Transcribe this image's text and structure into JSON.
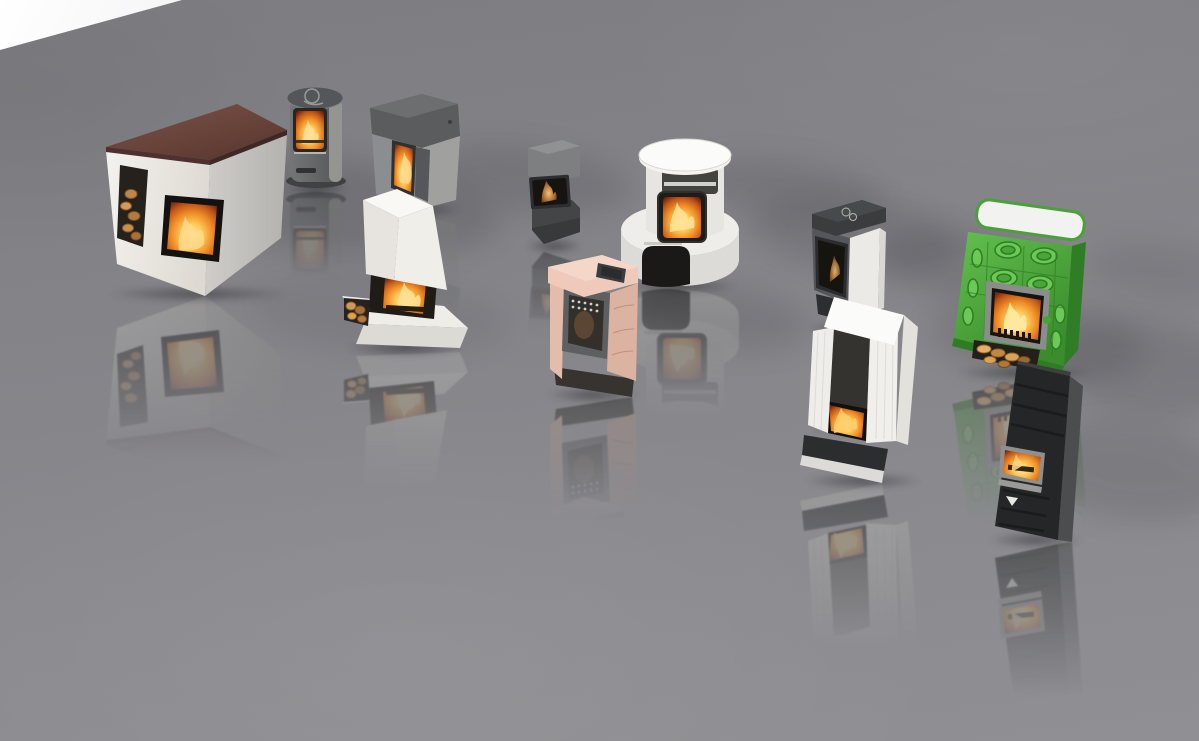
{
  "scene": {
    "title": "3D render of thirteen fireplace and wood stove models standing on a glossy reflective gray studio floor with a white backdrop in the top-left corner",
    "palette": {
      "backdrop": "#ffffff",
      "floor-top": "#7d7d81",
      "floor-mid": "#85858a",
      "floor-bottom": "#909094",
      "cream": "#f0ede8",
      "speckle-gray": "#c6c4c0",
      "maroon": "#6e4a42",
      "steel-gray": "#6d6f71",
      "charcoal": "#3a3c3e",
      "near-black": "#242527",
      "peach": "#e9c6b6",
      "tile-green": "#53b340",
      "fire-orange": "#ee8c26",
      "fire-bright": "#ffc857"
    },
    "stoves": [
      {
        "id": "white-maroon-stove",
        "label": "large white stove with maroon top slab, wood niche and fire window",
        "box": {
          "left": 103,
          "top": 104,
          "width": 190,
          "height": 192
        }
      },
      {
        "id": "gray-cylinder-stove",
        "label": "gray cylindrical stove with round top and fire window",
        "box": {
          "left": 284,
          "top": 84,
          "width": 66,
          "height": 106
        }
      },
      {
        "id": "gray-pellet-stove",
        "label": "tall gray pellet stove with vertical flame window",
        "box": {
          "left": 364,
          "top": 92,
          "width": 100,
          "height": 120
        }
      },
      {
        "id": "white-hearth-stove",
        "label": "white soapstone block stove over open firebox with log store",
        "box": {
          "left": 342,
          "top": 186,
          "width": 126,
          "height": 164
        }
      },
      {
        "id": "small-dark-stove",
        "label": "compact dark gray stove with small fire window",
        "box": {
          "left": 524,
          "top": 140,
          "width": 60,
          "height": 108
        }
      },
      {
        "id": "round-oven-stove",
        "label": "round white stove with fire window and baking oven base",
        "box": {
          "left": 618,
          "top": 138,
          "width": 122,
          "height": 150
        }
      },
      {
        "id": "peach-ceramic-stove",
        "label": "peach ceramic stove with dark fire door",
        "box": {
          "left": 544,
          "top": 253,
          "width": 98,
          "height": 144
        }
      },
      {
        "id": "dark-door-stove",
        "label": "dark door stove with white side pillars and faint flame",
        "box": {
          "left": 806,
          "top": 198,
          "width": 84,
          "height": 132
        }
      },
      {
        "id": "white-fluted-stove",
        "label": "white fluted stove with glowing firebox on dark plinth",
        "box": {
          "left": 800,
          "top": 293,
          "width": 126,
          "height": 190
        }
      },
      {
        "id": "green-tile-stove",
        "label": "green tiled masonry stove with white top, fire door and log store",
        "box": {
          "left": 952,
          "top": 198,
          "width": 144,
          "height": 177
        }
      },
      {
        "id": "black-column-stove",
        "label": "black column stove with fire window and chevron handle",
        "box": {
          "left": 986,
          "top": 360,
          "width": 100,
          "height": 182
        }
      }
    ],
    "floor_shadows": [
      {
        "left": 160,
        "top": 158,
        "width": 340,
        "height": 96,
        "rotate": 6,
        "opacity": 0.16
      },
      {
        "left": 425,
        "top": 146,
        "width": 205,
        "height": 66,
        "rotate": 7,
        "opacity": 0.13
      },
      {
        "left": 690,
        "top": 160,
        "width": 195,
        "height": 58,
        "rotate": 7,
        "opacity": 0.12
      },
      {
        "left": 750,
        "top": 198,
        "width": 210,
        "height": 74,
        "rotate": 7,
        "opacity": 0.13
      },
      {
        "left": 635,
        "top": 286,
        "width": 175,
        "height": 64,
        "rotate": 7,
        "opacity": 0.12
      },
      {
        "left": 880,
        "top": 230,
        "width": 185,
        "height": 70,
        "rotate": 7,
        "opacity": 0.12
      },
      {
        "left": 930,
        "top": 296,
        "width": 215,
        "height": 86,
        "rotate": 7,
        "opacity": 0.12
      },
      {
        "left": 1050,
        "top": 320,
        "width": 200,
        "height": 96,
        "rotate": 8,
        "opacity": 0.13
      },
      {
        "left": 1030,
        "top": 420,
        "width": 200,
        "height": 100,
        "rotate": 8,
        "opacity": 0.12
      },
      {
        "left": 1085,
        "top": 243,
        "width": 150,
        "height": 58,
        "rotate": 7,
        "opacity": 0.09
      },
      {
        "left": 250,
        "top": 275,
        "width": 260,
        "height": 80,
        "rotate": 5,
        "opacity": 0.07
      }
    ]
  }
}
